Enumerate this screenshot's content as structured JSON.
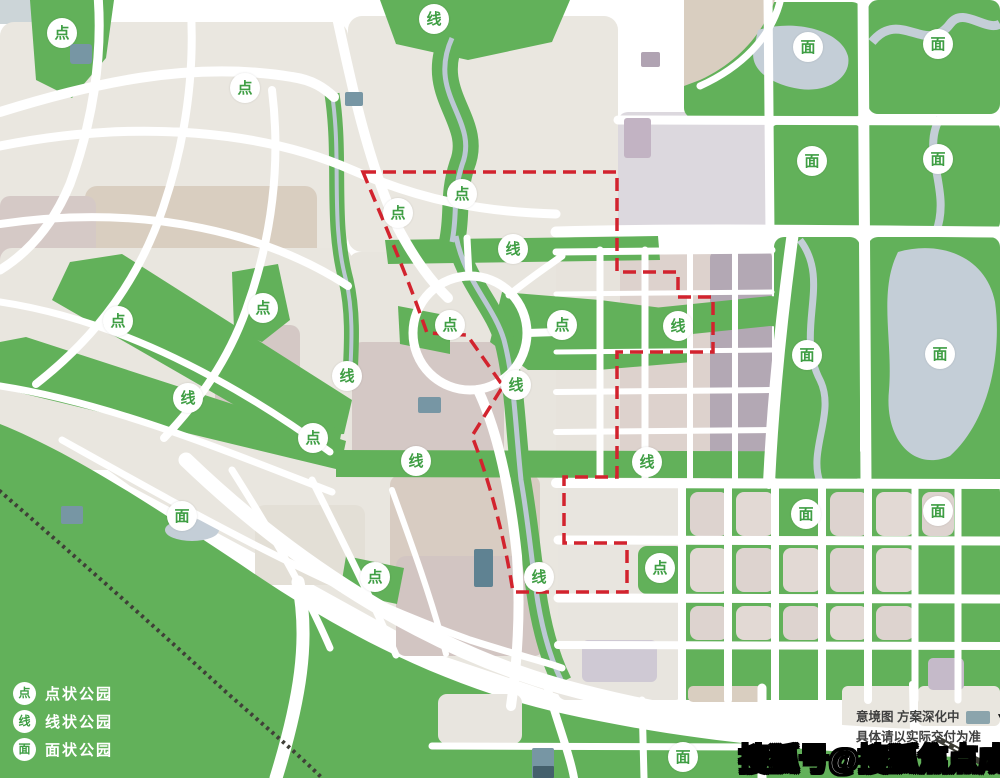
{
  "map": {
    "description": "park system planning map",
    "boundary_color": "#d2232e",
    "marker_glyphs": {
      "point": "点",
      "line": "线",
      "area": "面"
    },
    "markers": [
      {
        "type": "point",
        "label": "点",
        "x": 62,
        "y": 33
      },
      {
        "type": "point",
        "label": "点",
        "x": 245,
        "y": 88
      },
      {
        "type": "point",
        "label": "点",
        "x": 398,
        "y": 213
      },
      {
        "type": "point",
        "label": "点",
        "x": 462,
        "y": 194
      },
      {
        "type": "point",
        "label": "点",
        "x": 118,
        "y": 321
      },
      {
        "type": "point",
        "label": "点",
        "x": 263,
        "y": 308
      },
      {
        "type": "point",
        "label": "点",
        "x": 450,
        "y": 325
      },
      {
        "type": "point",
        "label": "点",
        "x": 562,
        "y": 325
      },
      {
        "type": "point",
        "label": "点",
        "x": 313,
        "y": 438
      },
      {
        "type": "point",
        "label": "点",
        "x": 375,
        "y": 577
      },
      {
        "type": "point",
        "label": "点",
        "x": 660,
        "y": 568
      },
      {
        "type": "line",
        "label": "线",
        "x": 434,
        "y": 19
      },
      {
        "type": "line",
        "label": "线",
        "x": 513,
        "y": 249
      },
      {
        "type": "line",
        "label": "线",
        "x": 678,
        "y": 326
      },
      {
        "type": "line",
        "label": "线",
        "x": 347,
        "y": 376
      },
      {
        "type": "line",
        "label": "线",
        "x": 516,
        "y": 385
      },
      {
        "type": "line",
        "label": "线",
        "x": 188,
        "y": 398
      },
      {
        "type": "line",
        "label": "线",
        "x": 416,
        "y": 461
      },
      {
        "type": "line",
        "label": "线",
        "x": 647,
        "y": 462
      },
      {
        "type": "line",
        "label": "线",
        "x": 539,
        "y": 577
      },
      {
        "type": "area",
        "label": "面",
        "x": 808,
        "y": 47
      },
      {
        "type": "area",
        "label": "面",
        "x": 938,
        "y": 44
      },
      {
        "type": "area",
        "label": "面",
        "x": 812,
        "y": 161
      },
      {
        "type": "area",
        "label": "面",
        "x": 938,
        "y": 159
      },
      {
        "type": "area",
        "label": "面",
        "x": 807,
        "y": 355
      },
      {
        "type": "area",
        "label": "面",
        "x": 940,
        "y": 354
      },
      {
        "type": "area",
        "label": "面",
        "x": 182,
        "y": 516
      },
      {
        "type": "area",
        "label": "面",
        "x": 806,
        "y": 514
      },
      {
        "type": "area",
        "label": "面",
        "x": 938,
        "y": 511
      },
      {
        "type": "area",
        "label": "面",
        "x": 683,
        "y": 757
      }
    ]
  },
  "legend": {
    "items": [
      {
        "badge": "点",
        "label": "点状公园"
      },
      {
        "badge": "线",
        "label": "线状公园"
      },
      {
        "badge": "面",
        "label": "面状公园"
      }
    ]
  },
  "disclaimer": {
    "line1": "意境图  方案深化中",
    "line2": "具体请以实际交付为准",
    "dropdown_icon": "▼"
  },
  "watermark": {
    "text": "搜狐号@搜狐焦点成都站"
  },
  "colors": {
    "park_green": "#62b15a",
    "road_white": "#ffffff",
    "parcel_greige": "#eae7e0",
    "parcel_tan": "#d9cec0",
    "parcel_mauve": "#d4c8c5",
    "parcel_purple_gray": "#b3a8b4",
    "parcel_lavender": "#dcd8de",
    "water_blue": "#c4ced7",
    "boundary_red": "#d2232e",
    "railway_dark": "#3f3f37",
    "marker_text_green": "#3f9e44",
    "legend_text_white": "#ffffff",
    "accent_teal": "#7796a4"
  }
}
